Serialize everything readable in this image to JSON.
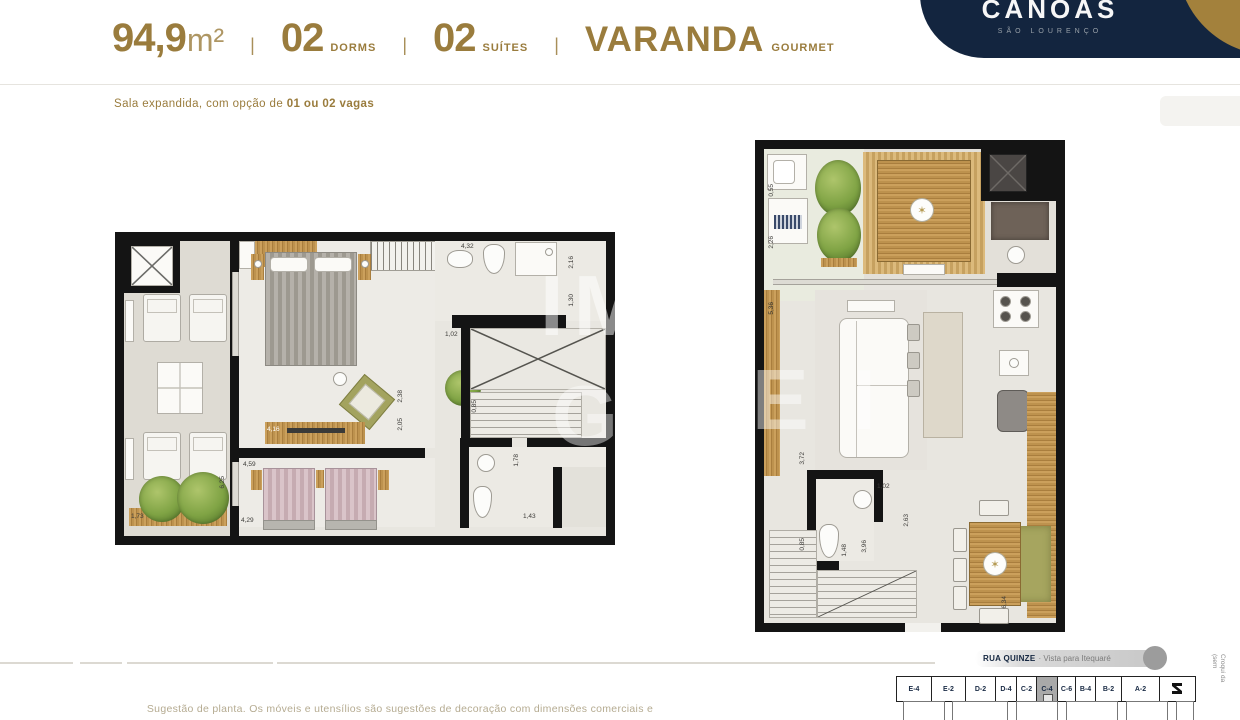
{
  "header": {
    "area_value": "94,9",
    "area_unit": "m²",
    "sep": "|",
    "dorms_value": "02",
    "dorms_label": "DORMS",
    "suites_value": "02",
    "suites_label": "SUÍTES",
    "varanda_value": "VARANDA",
    "varanda_label": "GOURMET"
  },
  "subtitle": {
    "regular": "Sala expandida, com opção de ",
    "bold": "01 ou 02 vagas"
  },
  "logo": {
    "name": "CANOAS",
    "subtitle": "SÃO LOURENÇO"
  },
  "colors": {
    "gold": "#9a7c3d",
    "navy": "#13253f",
    "wall_black": "#141414",
    "floor": "#e8e6e0",
    "wood": "#bd924e",
    "highlight_gray": "#a9a9a9"
  },
  "dims_left": [
    "4,32",
    "2,16",
    "1,30",
    "1,02",
    "4,16",
    "4,59",
    "2,38",
    "2,05",
    "0,85",
    "1,78",
    "1,43",
    "4,29",
    "6,25",
    "1,73"
  ],
  "dims_right": [
    "0,55",
    "2,26",
    "5,36",
    "3,72",
    "1,02",
    "2,63",
    "0,85",
    "1,48",
    "3,96",
    "6,34"
  ],
  "watermark": [
    "IM",
    "GA",
    "E I"
  ],
  "footer": {
    "disclaimer": "Sugestão de planta. Os móveis e utensílios são sugestões de decoração com dimensões comerciais e",
    "street_bold": "RUA QUINZE",
    "street_rest": "· Vista para Itequaré",
    "croqui_line1": "Croqui da",
    "croqui_line2": "(sem",
    "units": [
      "E-4",
      "E-2",
      "D-2",
      "D-4",
      "C-2",
      "C-4",
      "C-6",
      "B-4",
      "B-2",
      "A-2"
    ],
    "highlighted_unit": "C-4"
  }
}
